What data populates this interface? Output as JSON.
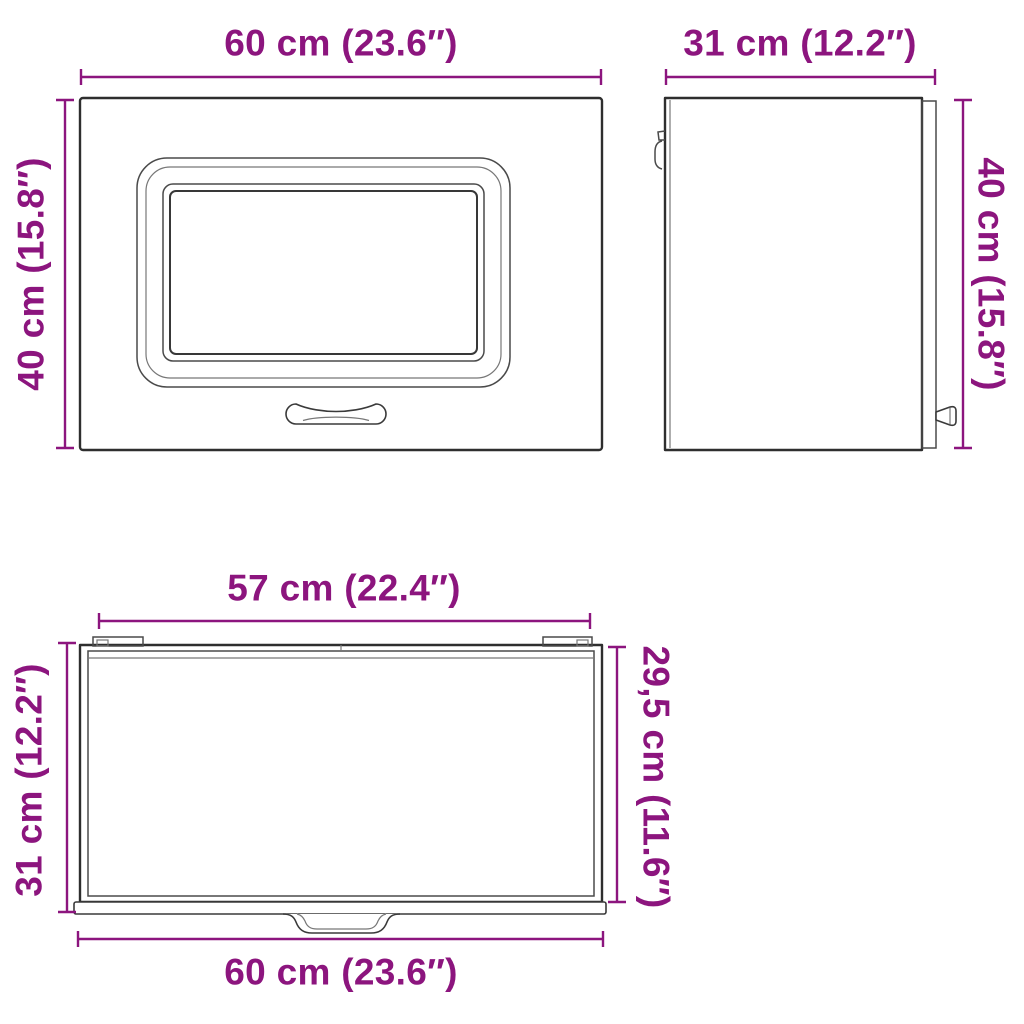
{
  "colors": {
    "dimension": "#8C157E",
    "line": "#2E2E2E",
    "background": "#FFFFFF"
  },
  "views": {
    "front": {
      "width_label": "60 cm (23.6″)",
      "height_label": "40 cm (15.8″)"
    },
    "side": {
      "depth_label": "31 cm (12.2″)",
      "height_label": "40 cm (15.8″)"
    },
    "top": {
      "inner_width_label": "57 cm (22.4″)",
      "depth_label": "31 cm (12.2″)",
      "inner_depth_label": "29,5 cm (11.6″)",
      "width_label": "60 cm (23.6″)"
    }
  }
}
